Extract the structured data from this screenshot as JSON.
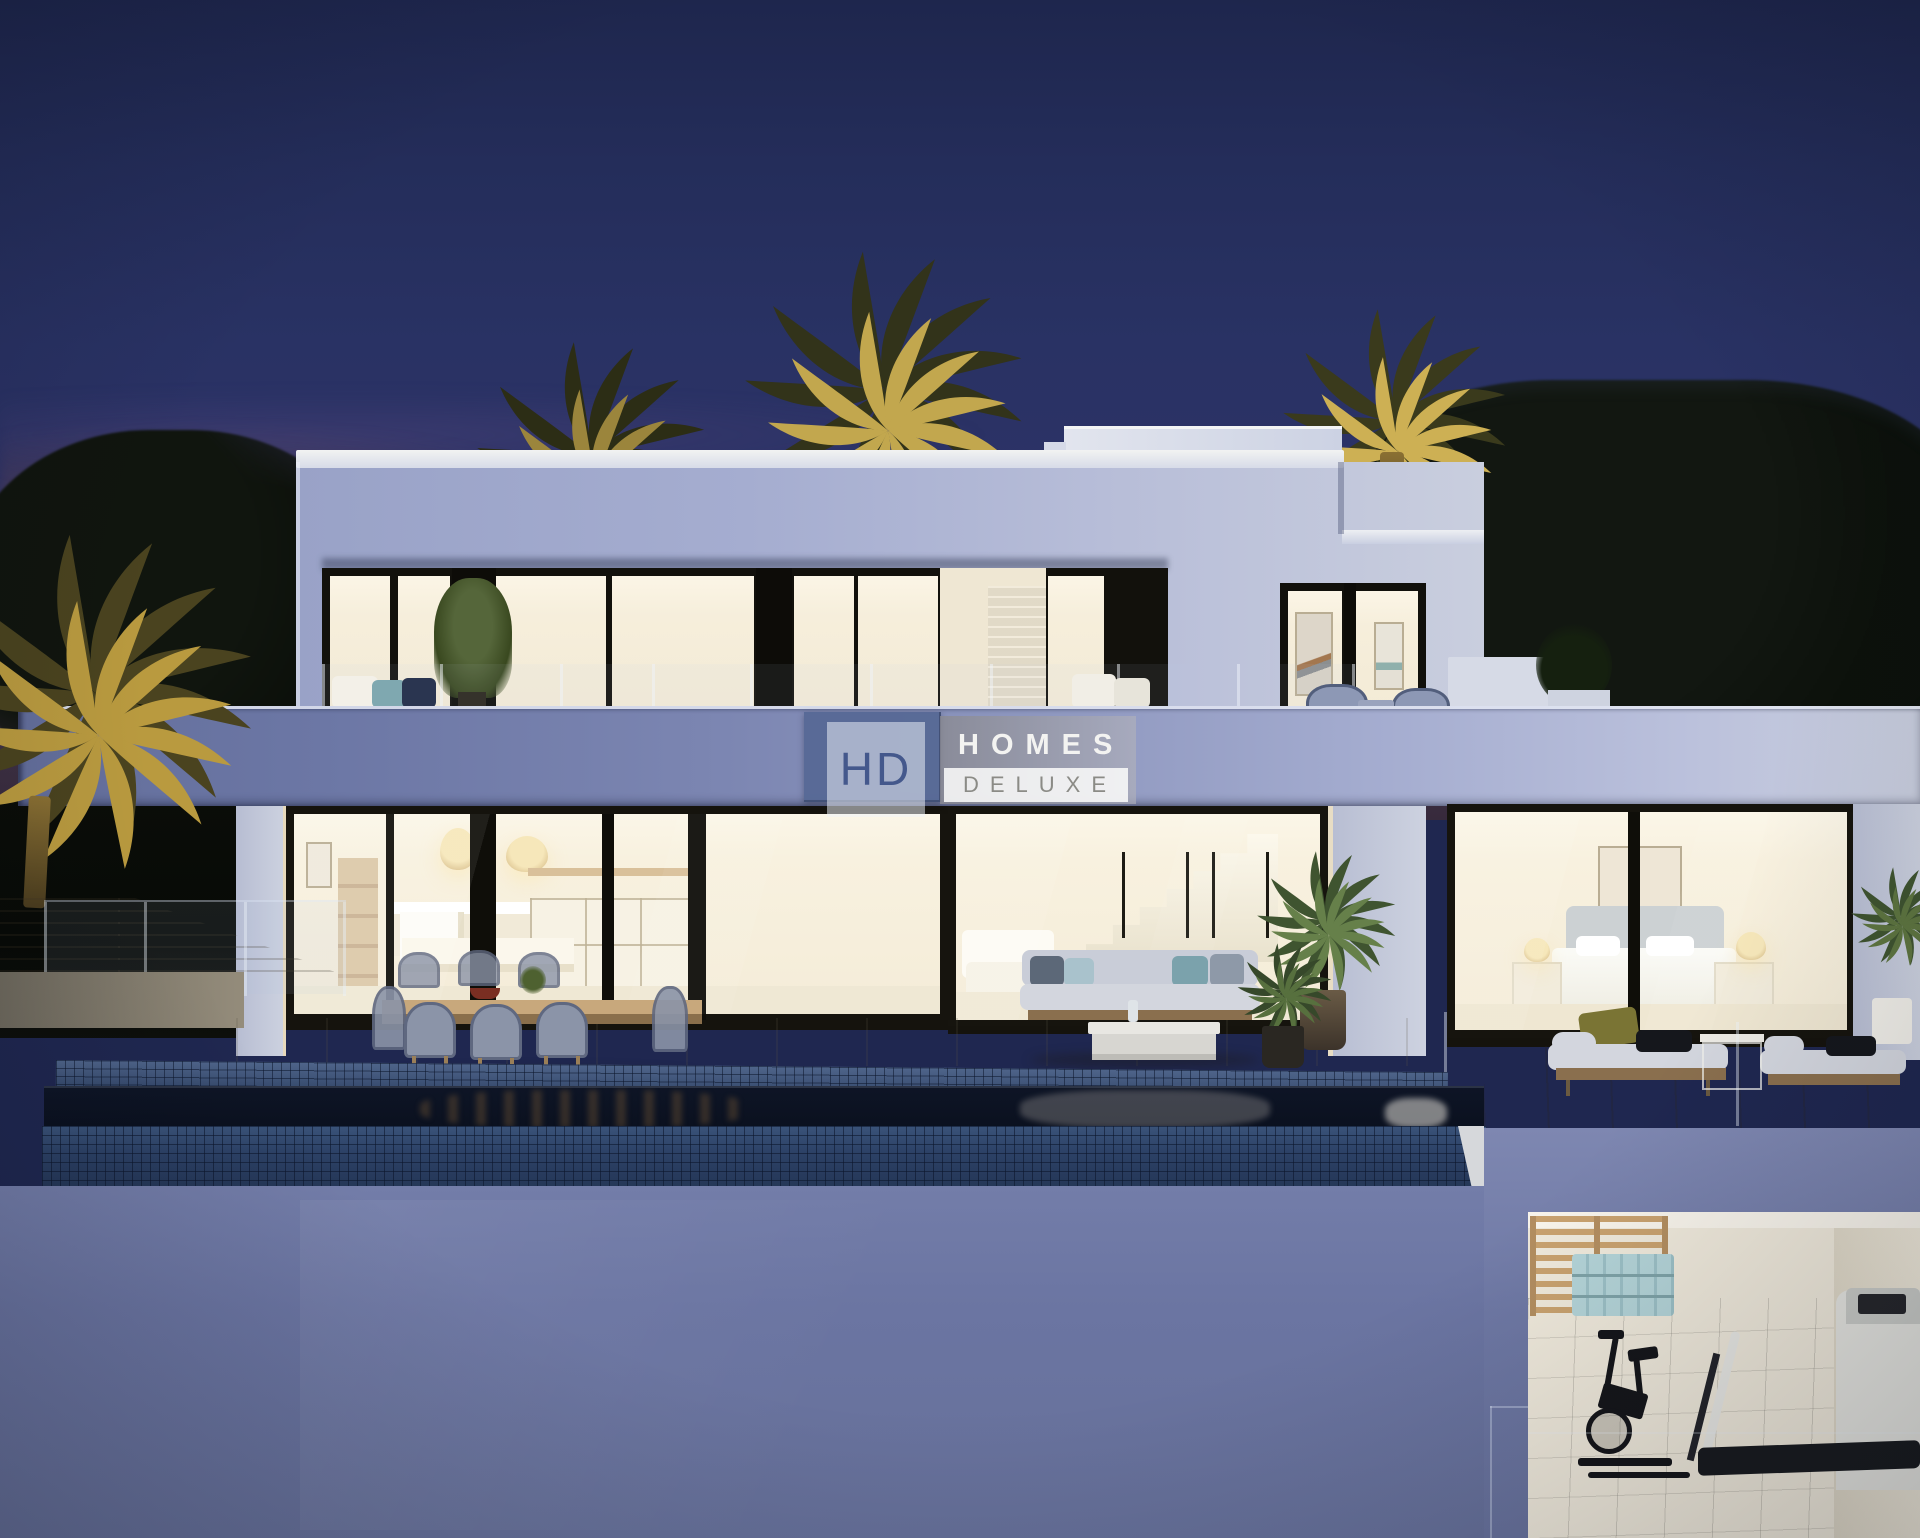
{
  "description": "Dusk 3D render of a modern two-storey luxury villa with infinity pool, outdoor dining and lounge furniture, illuminated palm trees, and a basement gym cutaway at lower right. Watermark logo over the terrace fascia.",
  "logo": {
    "monogram": "HD",
    "word_primary": "HOMES",
    "word_secondary": "DELUXE",
    "badge_color": "#56689",
    "monogram_color": "#44588c",
    "banner_color": "#9a9aa0",
    "secondary_text_color": "#8b8b86"
  },
  "palette": {
    "sky_top": "#1e264d",
    "sky_mid": "#293264",
    "dusk_glow": "#aa6046",
    "facade_shadow_lavender": "#99a2c7",
    "facade_light": "#c9cede",
    "fascia_left": "#636e9b",
    "fascia_right": "#c9cede",
    "window_warm_light": "#f8f1df",
    "frame_black": "#15130d",
    "pool_tile": "#35507c",
    "pool_water": "#0c1322",
    "lower_wall_blue": "#6b75a2",
    "palm_gold": "#c2a74e",
    "gym_wood": "#c9a26f",
    "yoga_mats": "#b4d4d8",
    "pavement_warm": "#d4ccbc"
  },
  "scene_elements": [
    "night-sky",
    "sunset-glow",
    "palm-trees",
    "background-trees",
    "upper-floor",
    "roof-bulkhead",
    "terrace-balustrade",
    "fascia-band",
    "watermark-logo",
    "kitchen-window",
    "living-room-window",
    "staircase",
    "bedroom-window",
    "outdoor-dining-set",
    "outdoor-sofa",
    "potted-palms",
    "daybeds",
    "infinity-pool",
    "mosaic-tiles",
    "pool-wall",
    "basement-gym",
    "wall-bars",
    "yoga-mats",
    "exercise-bike",
    "treadmill",
    "glass-pool-fence",
    "stone-planter"
  ]
}
